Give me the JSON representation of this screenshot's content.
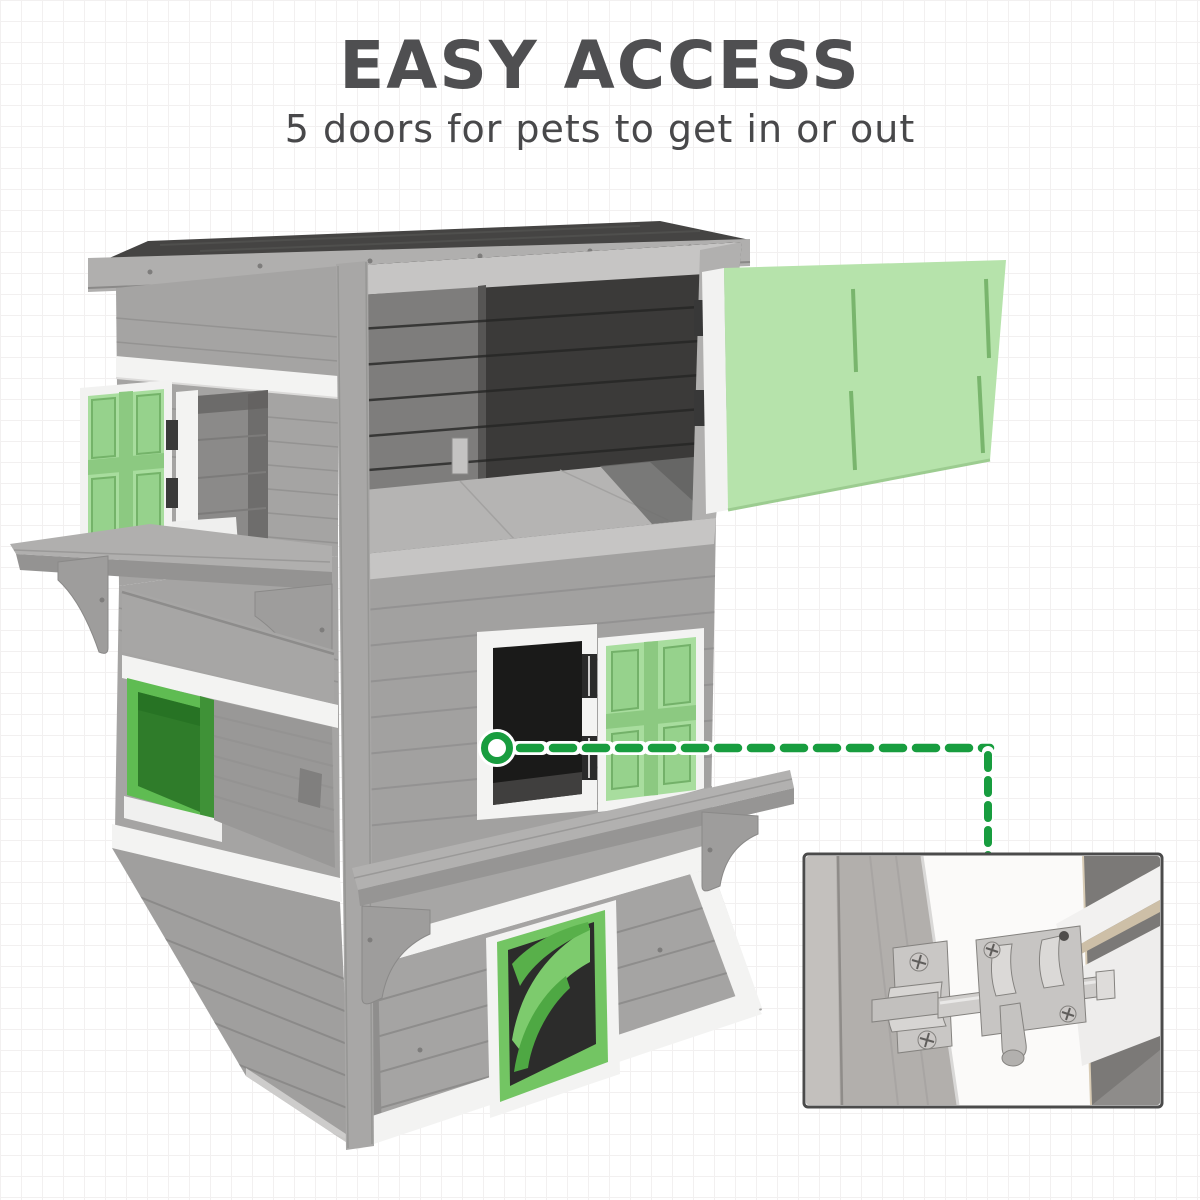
{
  "header": {
    "title": "EASY ACCESS",
    "subtitle": "5 doors for pets to get in or out"
  },
  "theme": {
    "accent": "#189d3f",
    "title-color": "#4f4f51",
    "subtitle-color": "#48484a",
    "grid-color": "#f2f0f0",
    "bg": "#ffffff",
    "wood": "#a5a4a3",
    "wood-dark": "#8e8d8c",
    "trim-white": "#f3f3f2",
    "pastel-green": "#b6e3ab",
    "shutter-green": "#a8dd9e",
    "pane-green": "#96d28c",
    "bright-green": "#5fbc52",
    "door-green": "#73c563",
    "roof-dark": "#454443",
    "interior-dark": "#1a1a19",
    "inset-border": "#4b4b4b",
    "metal": "#cfcdcb"
  },
  "product": {
    "description": "Three-tier grey wooden cat house with white trim, green doors, shutter windows, two perch shelves and an open flat roof door",
    "doors_count": "5"
  },
  "callout": {
    "marker": "green ring on middle door frame",
    "target": "sliding barrel-bolt latch close-up"
  },
  "inset": {
    "content": "close-up photo of a stainless steel barrel bolt latch on a white door frame"
  }
}
